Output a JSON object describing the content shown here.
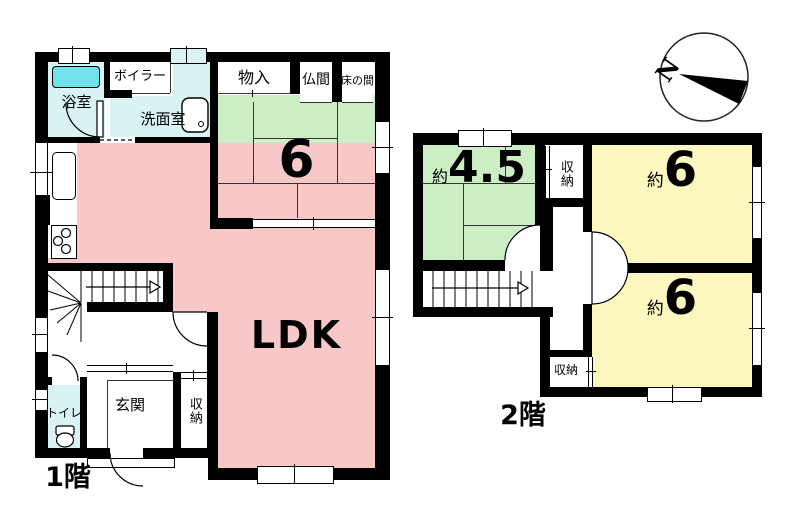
{
  "floor1": {
    "title": "1階",
    "rooms": {
      "bathroom": "浴室",
      "boiler": "ボイラー",
      "washroom": "洗面室",
      "storage": "物入",
      "butsuma": "仏間",
      "tokonoma": "床の間",
      "tatami_count": "6",
      "ldk": "LDK",
      "toilet": "トイレ",
      "entrance": "玄関",
      "closet": "収納"
    }
  },
  "floor2": {
    "title": "2階",
    "approx": "約",
    "rooms": {
      "tatami45": "4.5",
      "tatami6_upper": "6",
      "tatami6_lower": "6",
      "closet_upper": "収納",
      "closet_lower": "収納"
    }
  },
  "compass": {
    "north": "N"
  },
  "colors": {
    "ldk": "#F8C8C8",
    "tatami_room": "#CBEEC4",
    "western_room": "#FBF7BE",
    "wet_area": "#D9F2F3",
    "bathtub": "#6FE3E8",
    "wall": "#000000"
  }
}
